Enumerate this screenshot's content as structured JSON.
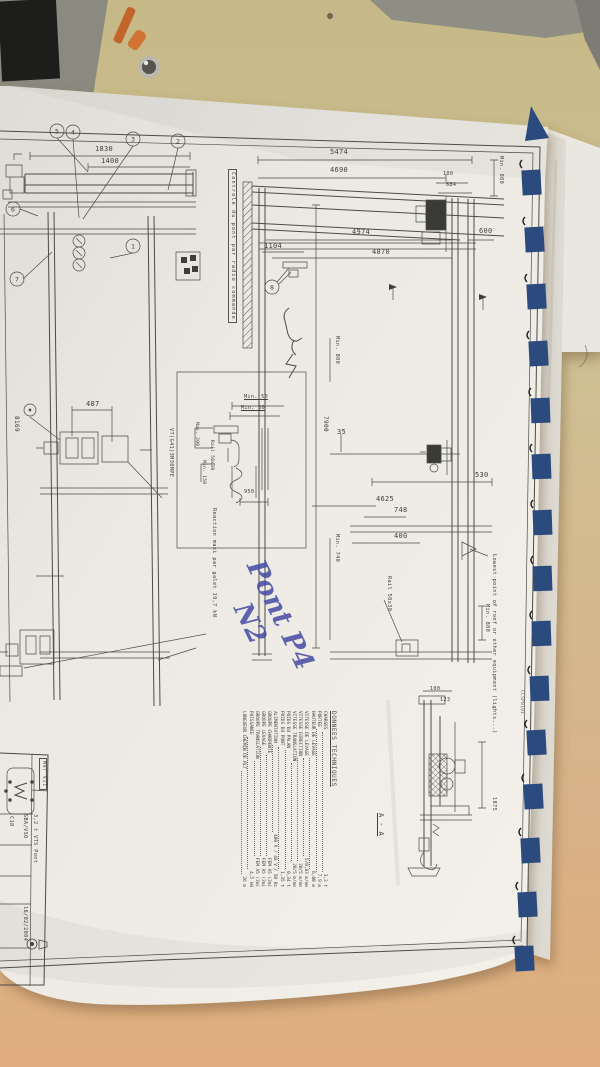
{
  "colors": {
    "binding_blue": "#2b4a7d",
    "handwriting_blue": "#4649a5",
    "paper_white": "#edebe5",
    "table_tan": "#d3b285",
    "line_ink": "#4c4b45"
  },
  "drawing": {
    "plan_view": {
      "dim_1830": "1830",
      "dim_1400": "1400",
      "dim_487": "487",
      "rail_ref": "8169",
      "hoist_ref": "VT(G41)3M30MPE",
      "control_note": "Controle du pont par radio commande",
      "balloons": [
        "5",
        "4",
        "3",
        "2",
        "6",
        "7",
        "1"
      ]
    },
    "elevation_view": {
      "dim_5474": "5474",
      "dim_4690": "4690",
      "dim_100": "100",
      "dim_684": "684",
      "min_800_top": "Min. 800",
      "dim_600": "600",
      "dim_4974": "4974",
      "dim_1104": "1104",
      "dim_4870": "4870",
      "min_800_mid": "Min. 800",
      "dim_7900": "7900",
      "dim_35": "35",
      "dim_530": "530",
      "dim_4625": "4625",
      "dim_748": "748",
      "dim_400": "400",
      "min_740": "Min. 740",
      "rail_label": "Rail 50x30",
      "lowest_point_note": "Lowest point of roof or other equipment (lights...)",
      "min_800_roof": "Min. 800",
      "ref_code": "CLSP0191",
      "balloon": "8"
    },
    "detail_view": {
      "min_50": "Min. 50",
      "min_30": "Min. 30",
      "dim_950": "950",
      "max_200": "Max. 200",
      "rail_label": "Rail 50x30",
      "min_150": "Min. 150",
      "reaction_note": "Reaction maxi par galet 19,7 kN"
    },
    "section_view": {
      "label": "A - A",
      "dim_100": "100",
      "dim_123": "123",
      "dim_1875": "1875"
    },
    "tech_data": {
      "title": "DONNEES TECHNIQUES",
      "rows": [
        {
          "label": "CHARGES",
          "value": "3,2 t"
        },
        {
          "label": "PORTEE",
          "value": "7,9 m"
        },
        {
          "label": "HAUTEUR DE LEVAGE",
          "value": "6,00 m"
        },
        {
          "label": "VITESSE DE LEVAGE",
          "value": "5/0,83 m/mn"
        },
        {
          "label": "VITESSE DIRECTION",
          "value": "20/5 m/mn"
        },
        {
          "label": "VITESSE TRANSLATION",
          "value": "20/5 m/mn"
        },
        {
          "label": "POIDS DU PALAN",
          "value": "0,34 t"
        },
        {
          "label": "POIDS DU PONT",
          "value": "1,35 t"
        },
        {
          "label": "ALIMENTATION",
          "value": "400 V / 48 V / 50 Hz"
        },
        {
          "label": "GROUPE CHARPENTE",
          "value": "FEM A5 (2m)"
        },
        {
          "label": "GROUPE LEVAGE",
          "value": "FEM A5 (2m)"
        },
        {
          "label": "GROUPE TRANSLATION",
          "value": "FEM A5 (2m)"
        },
        {
          "label": "PUISSANCE",
          "value": "4,5 kW"
        },
        {
          "label": "LONGUEUR CHEMIN DE RLT",
          "value": "26 m"
        }
      ]
    },
    "title_block": {
      "stamp": "MAT VII",
      "ref": "C18",
      "company": "SBA/VSO",
      "title": "3,2 t VTS Pont",
      "date": "16/02/2004"
    },
    "handwriting": {
      "line1": "Pont P4",
      "line2": "N2"
    }
  }
}
